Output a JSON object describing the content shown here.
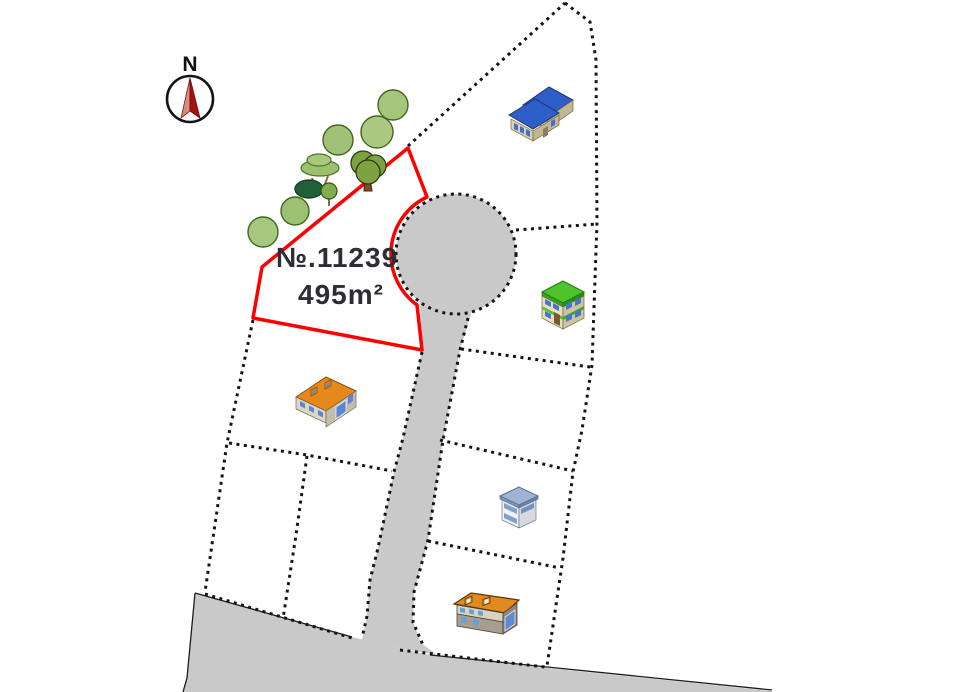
{
  "page": {
    "kind": "residential-lot-layout-map",
    "background": "#ffffff"
  },
  "plot": {
    "number_label": "№.11239",
    "area_label": "495m²",
    "outline_color": "#ff0000"
  },
  "compass": {
    "label": "N",
    "needle_color": "#a31313"
  },
  "road": {
    "fill": "#c9c9c9",
    "type": "cul-de-sac with access lane and lower street"
  },
  "boundary": {
    "style": "dotted",
    "color": "#141414"
  },
  "trees": {
    "count": 9,
    "colors": [
      "#a5c77b",
      "#7da23f",
      "#20613a",
      "#9cc06c"
    ]
  },
  "houses": [
    {
      "icon": "blue-roof-house-icon",
      "roof_color": "#2e5ec8"
    },
    {
      "icon": "green-roof-house-icon",
      "roof_color": "#4fc32e"
    },
    {
      "icon": "orange-roof-house-icon",
      "roof_color": "#e6891c"
    },
    {
      "icon": "small-office-building-icon",
      "roof_color": "#9db4d4"
    },
    {
      "icon": "orange-gray-house-icon",
      "roof_color": "#e08a20"
    }
  ]
}
